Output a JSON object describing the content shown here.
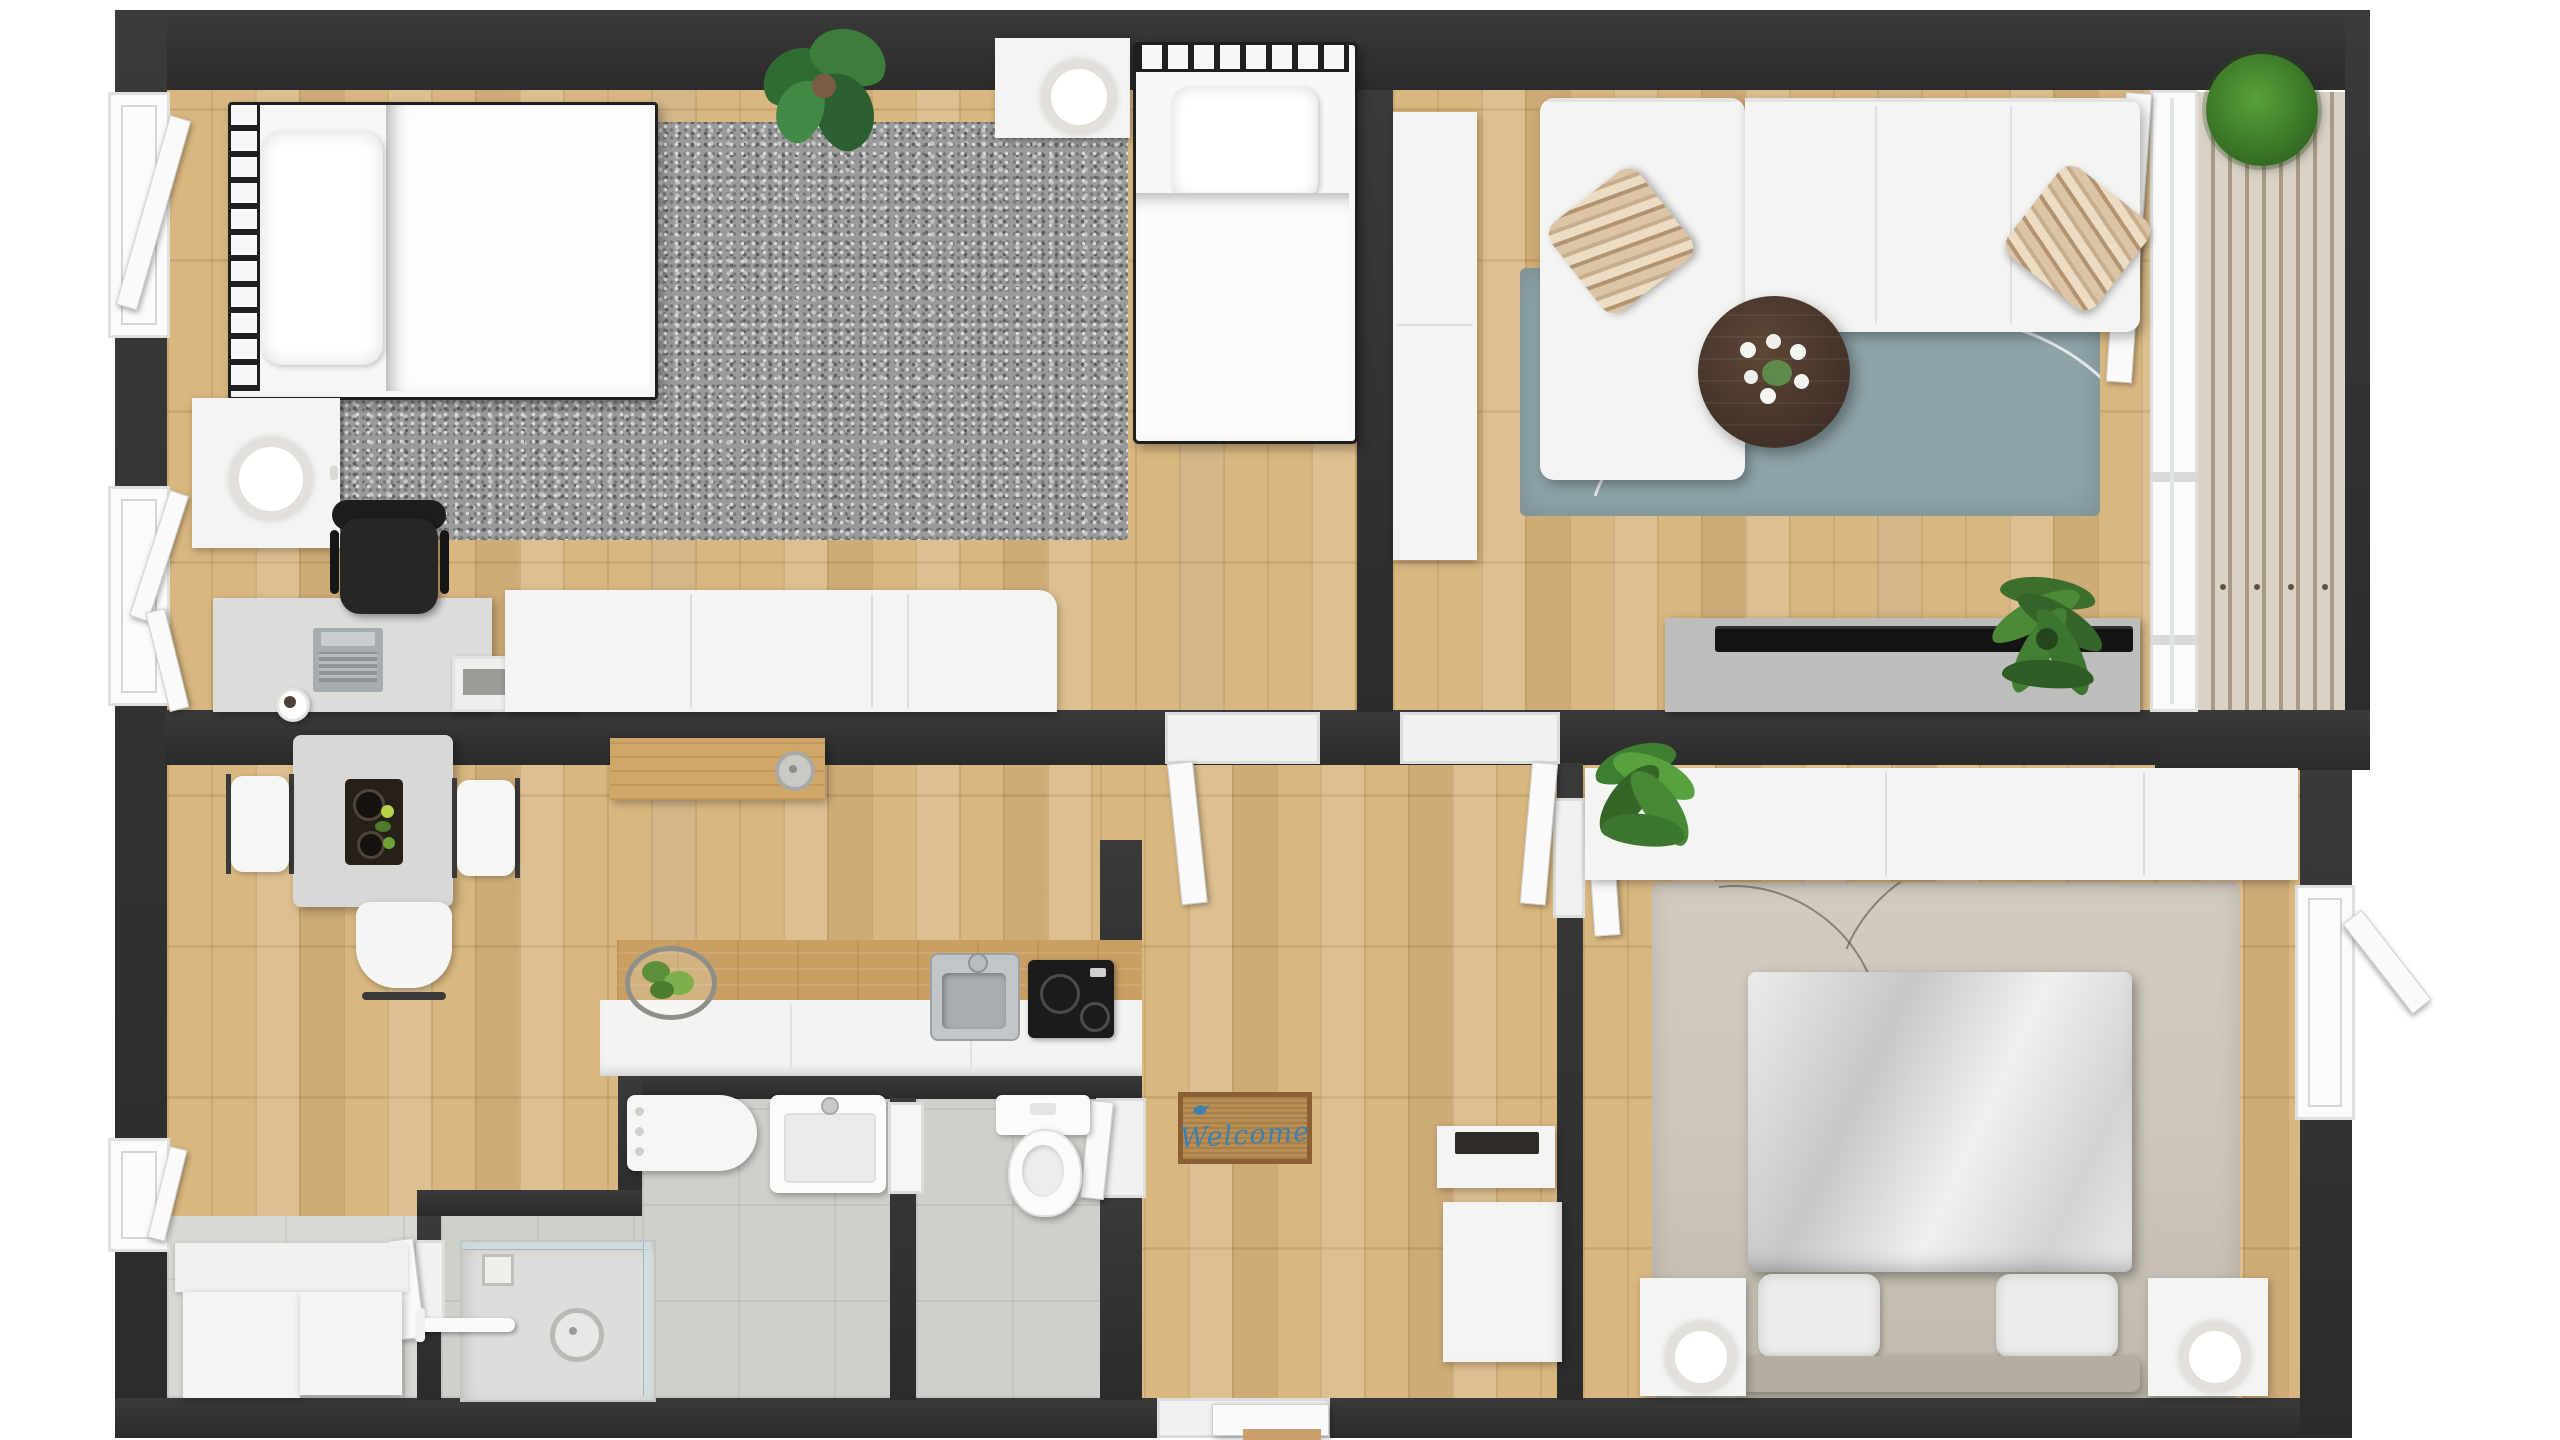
{
  "scene": {
    "kind": "apartment-floor-plan-3d-top-view",
    "rooms": [
      "bedroom-1",
      "living-room",
      "balcony",
      "kitchen-dining",
      "bathroom",
      "wc",
      "hallway",
      "bedroom-2"
    ]
  },
  "text": {
    "welcome_mat": "Welcome"
  },
  "palette": {
    "wall": "#303030",
    "wood_floor": "#d9b780",
    "tile_floor": "#d8d8d5",
    "bath_tile": "#cfcfcc",
    "shag_rug": "#9a9a9a",
    "living_rug": "#8ea4a9",
    "bedroom2_rug": "#ccc6b9",
    "furniture_white": "#f4f4f2",
    "coffee_table": "#4a372c",
    "welcome_mat_bg": "#b98e54",
    "welcome_text_blue": "#3f7fae",
    "plant_green": "#3c6e2d",
    "tv_black": "#141414"
  },
  "rooms": {
    "bedroom_1": {
      "furniture": [
        "double-bed-metal-frame",
        "pillow",
        "nightstand-with-lamp",
        "shag-rug",
        "desk",
        "laptop",
        "office-chair",
        "cup",
        "desk-tray-books",
        "long-dresser",
        "single-bed-metal-frame",
        "single-bed-nightstand-with-lamp",
        "monstera-plant"
      ],
      "windows": [
        "left-wall-casement-window-open"
      ]
    },
    "living_room": {
      "furniture": [
        "white-sectional-sofa-with-chaise",
        "striped-pillow-left",
        "striped-pillow-right",
        "blue-gray-wave-rug",
        "round-dark-coffee-table-with-flowers",
        "tall-side-cabinet",
        "tv-console",
        "flat-tv",
        "fern-plant"
      ],
      "doors": [
        "balcony-door-open"
      ]
    },
    "balcony": {
      "furniture": [
        "wood-slat-deck",
        "round-grass-plant"
      ]
    },
    "kitchen_dining": {
      "furniture": [
        "dining-table",
        "serving-tray-with-food",
        "dining-chair-left",
        "dining-chair-right",
        "dining-chair-bottom",
        "wooden-console-with-cake-stand",
        "kitchen-counter",
        "wire-basket-with-greens",
        "kitchen-sink-metal",
        "cooktop-black",
        "storage-cabinet-1",
        "storage-cabinet-2"
      ],
      "windows": [
        "left-wall-window-upper-open",
        "left-wall-window-lower-open"
      ]
    },
    "bathroom": {
      "fixtures": [
        "washing-machine",
        "square-washbasin-with-faucet",
        "wall-niche-shelf",
        "shower-with-glass-enclosure",
        "shower-drain",
        "towel-bar"
      ]
    },
    "wc": {
      "fixtures": [
        "toilet-with-tank"
      ]
    },
    "hallway": {
      "furniture": [
        "welcome-door-mat",
        "shoe-cabinet-with-tray",
        "hall-cabinet"
      ],
      "doors": [
        "entrance-door-bottom",
        "door-to-bedroom-1",
        "door-to-living-room",
        "door-to-bedroom-2",
        "door-to-wc"
      ]
    },
    "bedroom_2": {
      "furniture": [
        "long-wardrobe",
        "leafy-plant",
        "abstract-gray-rug",
        "double-bed-silver-duvet",
        "pillow-left",
        "pillow-right",
        "headboard-bench",
        "nightstand-left-with-ring-lamp",
        "nightstand-right-with-ring-lamp"
      ],
      "windows": [
        "right-wall-casement-window-open"
      ]
    }
  }
}
